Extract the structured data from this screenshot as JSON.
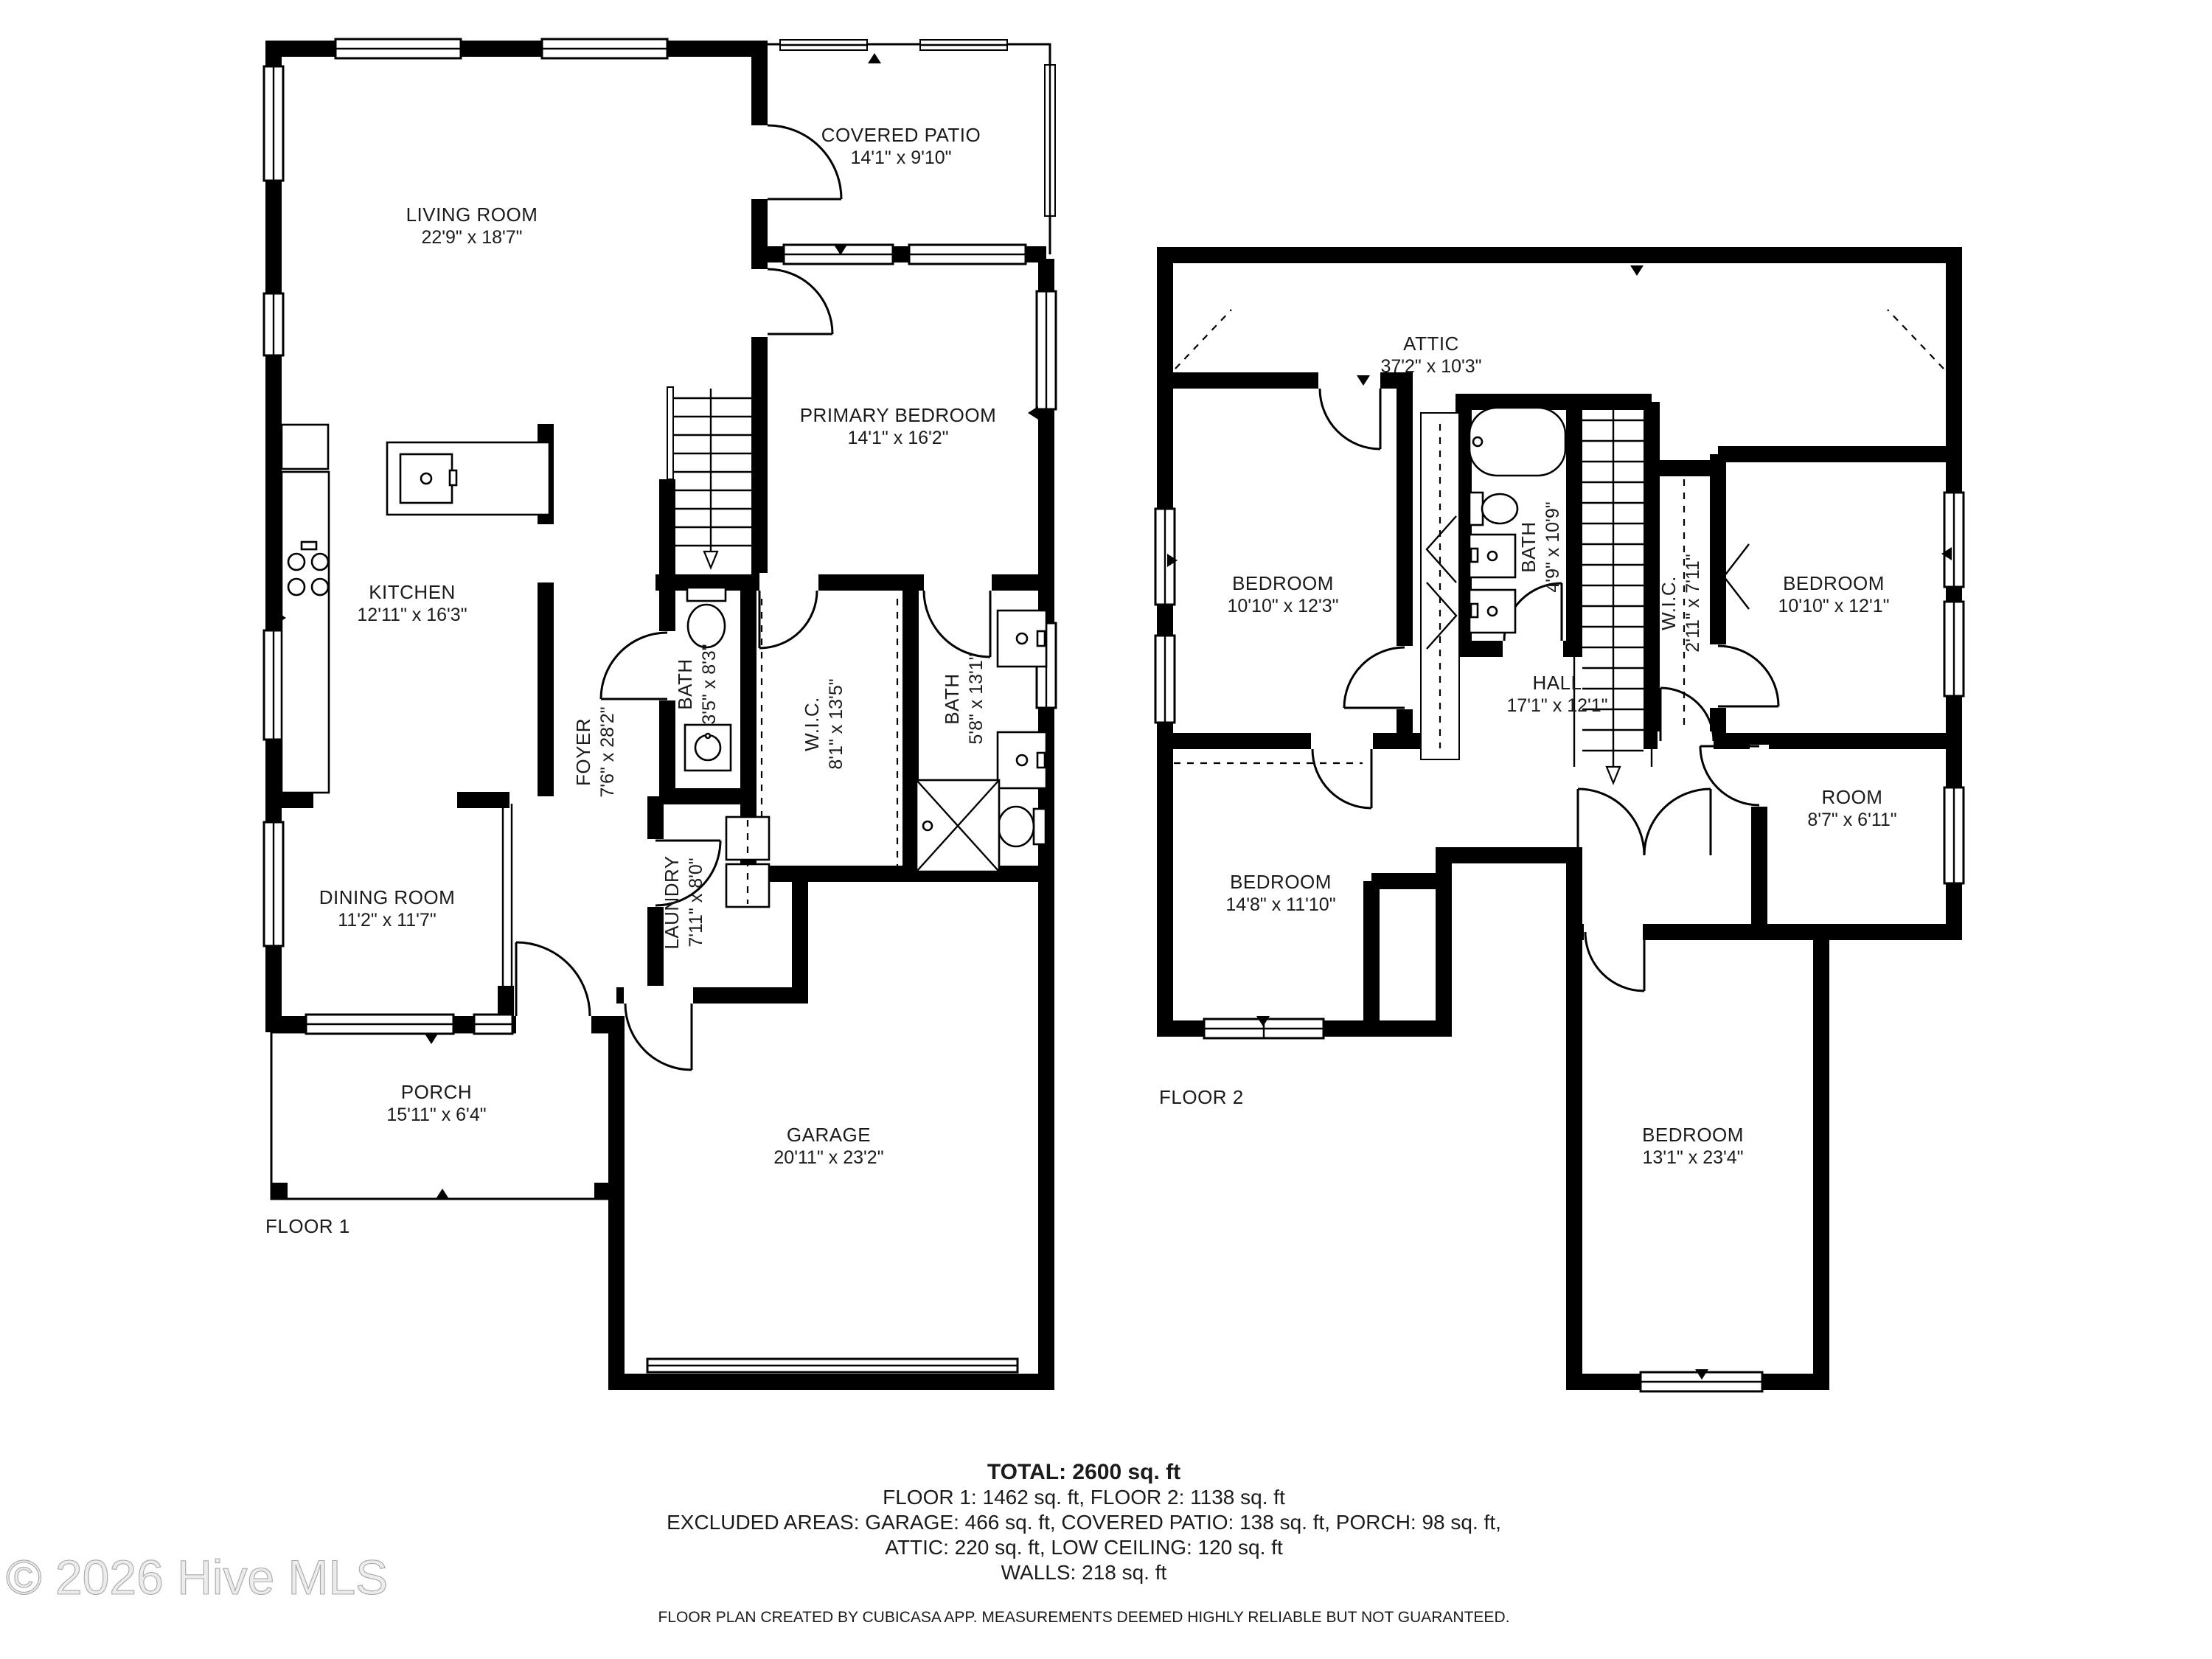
{
  "floor1": {
    "label": "FLOOR 1",
    "rooms": {
      "living": {
        "name": "LIVING ROOM",
        "dims": "22'9\" x 18'7\""
      },
      "patio": {
        "name": "COVERED PATIO",
        "dims": "14'1\" x 9'10\""
      },
      "primary": {
        "name": "PRIMARY BEDROOM",
        "dims": "14'1\" x 16'2\""
      },
      "kitchen": {
        "name": "KITCHEN",
        "dims": "12'11\" x 16'3\""
      },
      "bath": {
        "name": "BATH",
        "dims": "3'5\" x 8'3\""
      },
      "foyer": {
        "name": "FOYER",
        "dims": "7'6\" x 28'2\""
      },
      "wic": {
        "name": "W.I.C.",
        "dims": "8'1\" x 13'5\""
      },
      "bath2": {
        "name": "BATH",
        "dims": "5'8\" x 13'1\""
      },
      "laundry": {
        "name": "LAUNDRY",
        "dims": "7'11\" x 8'0\""
      },
      "dining": {
        "name": "DINING ROOM",
        "dims": "11'2\" x 11'7\""
      },
      "porch": {
        "name": "PORCH",
        "dims": "15'11\" x 6'4\""
      },
      "garage": {
        "name": "GARAGE",
        "dims": "20'11\" x 23'2\""
      }
    }
  },
  "floor2": {
    "label": "FLOOR 2",
    "rooms": {
      "attic": {
        "name": "ATTIC",
        "dims": "37'2\" x 10'3\""
      },
      "bedroom_left": {
        "name": "BEDROOM",
        "dims": "10'10\" x 12'3\""
      },
      "bath": {
        "name": "BATH",
        "dims": "4'9\" x 10'9\""
      },
      "wic": {
        "name": "W.I.C.",
        "dims": "2'11\" x 7'11\""
      },
      "bedroom_right": {
        "name": "BEDROOM",
        "dims": "10'10\" x 12'1\""
      },
      "hall": {
        "name": "HALL",
        "dims": "17'1\" x 12'1\""
      },
      "room": {
        "name": "ROOM",
        "dims": "8'7\" x 6'11\""
      },
      "bedroom_mid": {
        "name": "BEDROOM",
        "dims": "14'8\" x 11'10\""
      },
      "bedroom_bottom": {
        "name": "BEDROOM",
        "dims": "13'1\" x 23'4\""
      }
    }
  },
  "summary": {
    "total": "TOTAL: 2600 sq. ft",
    "floors": "FLOOR 1: 1462 sq. ft, FLOOR 2: 1138 sq. ft",
    "excluded1": "EXCLUDED AREAS: GARAGE: 466 sq. ft, COVERED PATIO: 138 sq. ft, PORCH: 98 sq. ft,",
    "excluded2": "ATTIC: 220 sq. ft, LOW CEILING: 120 sq. ft",
    "walls": "WALLS: 218 sq. ft",
    "disclaimer": "FLOOR PLAN CREATED BY CUBICASA APP. MEASUREMENTS DEEMED HIGHLY RELIABLE BUT NOT GUARANTEED."
  },
  "watermark": "© 2026 Hive MLS"
}
